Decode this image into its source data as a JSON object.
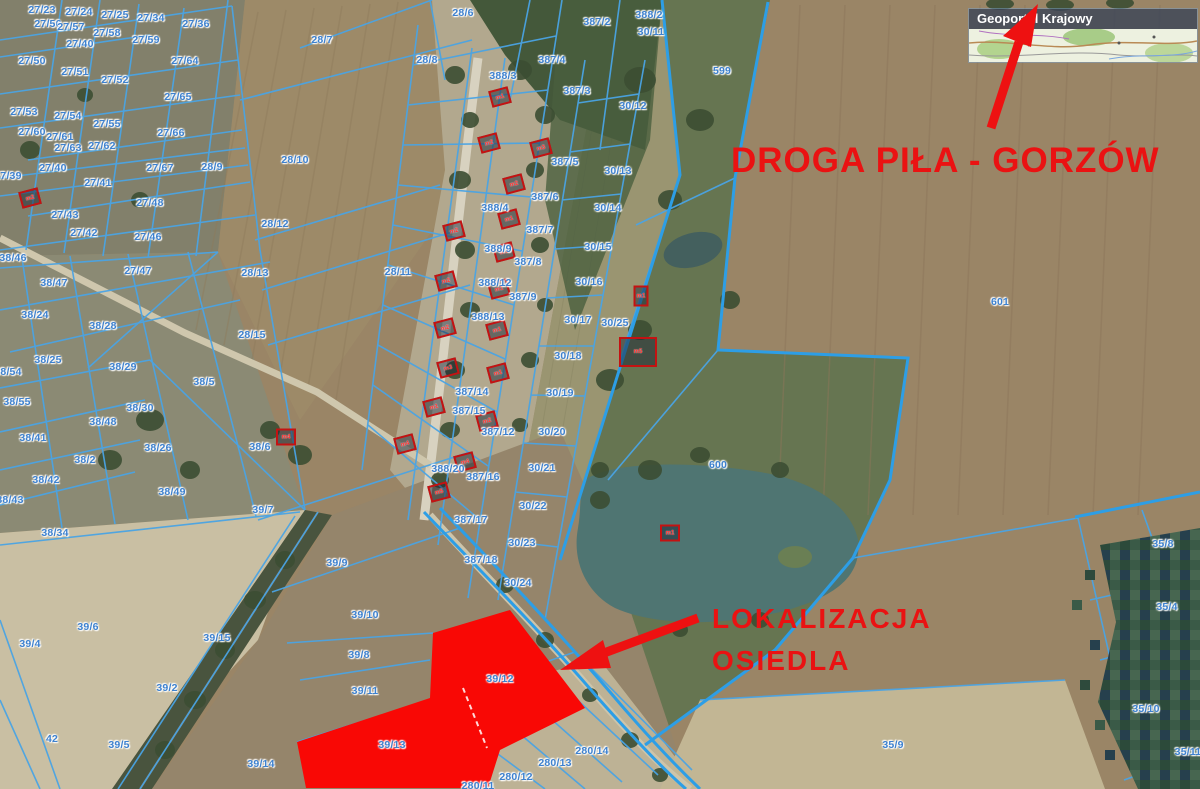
{
  "map": {
    "source_label": "Geoportal Krajowy",
    "annotations": {
      "road_label": "DROGA PIŁA - GORZÓW",
      "location_label_line1": "LOKALIZACJA",
      "location_label_line2": "OSIEDLA"
    },
    "colors": {
      "annotation_red": "#ea1212",
      "highlight_parcel_red": "#f90805",
      "parcel_line_blue": "#4aa3e4",
      "parcel_label_blue": "#3d81cf"
    },
    "highlighted_parcels": [
      "39/12",
      "39/13"
    ],
    "parcel_labels": [
      {
        "text": "27/23",
        "x": 42,
        "y": 10
      },
      {
        "text": "27/24",
        "x": 79,
        "y": 12
      },
      {
        "text": "27/25",
        "x": 115,
        "y": 15
      },
      {
        "text": "27/34",
        "x": 151,
        "y": 18
      },
      {
        "text": "27/36",
        "x": 196,
        "y": 24
      },
      {
        "text": "27/56",
        "x": 48,
        "y": 24
      },
      {
        "text": "27/57",
        "x": 71,
        "y": 27
      },
      {
        "text": "27/58",
        "x": 107,
        "y": 33
      },
      {
        "text": "27/59",
        "x": 146,
        "y": 40
      },
      {
        "text": "27/40",
        "x": 80,
        "y": 44
      },
      {
        "text": "27/50",
        "x": 32,
        "y": 61
      },
      {
        "text": "27/64",
        "x": 185,
        "y": 61
      },
      {
        "text": "27/51",
        "x": 75,
        "y": 72
      },
      {
        "text": "27/52",
        "x": 115,
        "y": 80
      },
      {
        "text": "27/65",
        "x": 178,
        "y": 97
      },
      {
        "text": "27/53",
        "x": 24,
        "y": 112
      },
      {
        "text": "27/54",
        "x": 68,
        "y": 116
      },
      {
        "text": "27/55",
        "x": 107,
        "y": 124
      },
      {
        "text": "27/66",
        "x": 171,
        "y": 133
      },
      {
        "text": "27/60",
        "x": 32,
        "y": 132
      },
      {
        "text": "27/61",
        "x": 60,
        "y": 137
      },
      {
        "text": "27/62",
        "x": 102,
        "y": 146
      },
      {
        "text": "27/63",
        "x": 68,
        "y": 148
      },
      {
        "text": "27/39",
        "x": 8,
        "y": 176
      },
      {
        "text": "27/40",
        "x": 53,
        "y": 168
      },
      {
        "text": "27/41",
        "x": 98,
        "y": 183
      },
      {
        "text": "27/67",
        "x": 160,
        "y": 168
      },
      {
        "text": "28/9",
        "x": 212,
        "y": 167
      },
      {
        "text": "28/10",
        "x": 295,
        "y": 160
      },
      {
        "text": "27/48",
        "x": 150,
        "y": 203
      },
      {
        "text": "27/43",
        "x": 65,
        "y": 215
      },
      {
        "text": "27/42",
        "x": 84,
        "y": 233
      },
      {
        "text": "27/46",
        "x": 148,
        "y": 237
      },
      {
        "text": "28/12",
        "x": 275,
        "y": 224
      },
      {
        "text": "27/47",
        "x": 138,
        "y": 271
      },
      {
        "text": "28/13",
        "x": 255,
        "y": 273
      },
      {
        "text": "28/15",
        "x": 252,
        "y": 335
      },
      {
        "text": "28/7",
        "x": 322,
        "y": 40
      },
      {
        "text": "28/6",
        "x": 463,
        "y": 13
      },
      {
        "text": "28/8",
        "x": 427,
        "y": 60
      },
      {
        "text": "28/11",
        "x": 398,
        "y": 272
      },
      {
        "text": "388/2",
        "x": 649,
        "y": 15
      },
      {
        "text": "387/2",
        "x": 597,
        "y": 22
      },
      {
        "text": "387/4",
        "x": 552,
        "y": 60
      },
      {
        "text": "388/3",
        "x": 503,
        "y": 76
      },
      {
        "text": "387/3",
        "x": 577,
        "y": 91
      },
      {
        "text": "30/11",
        "x": 651,
        "y": 32
      },
      {
        "text": "599",
        "x": 722,
        "y": 71
      },
      {
        "text": "30/12",
        "x": 633,
        "y": 106
      },
      {
        "text": "30/13",
        "x": 618,
        "y": 171
      },
      {
        "text": "30/14",
        "x": 608,
        "y": 208
      },
      {
        "text": "387/5",
        "x": 565,
        "y": 162
      },
      {
        "text": "387/6",
        "x": 545,
        "y": 197
      },
      {
        "text": "388/4",
        "x": 495,
        "y": 208
      },
      {
        "text": "387/7",
        "x": 540,
        "y": 230
      },
      {
        "text": "30/15",
        "x": 598,
        "y": 247
      },
      {
        "text": "388/9",
        "x": 498,
        "y": 249
      },
      {
        "text": "387/8",
        "x": 528,
        "y": 262
      },
      {
        "text": "388/12",
        "x": 495,
        "y": 283
      },
      {
        "text": "387/9",
        "x": 523,
        "y": 297
      },
      {
        "text": "30/16",
        "x": 589,
        "y": 282
      },
      {
        "text": "388/13",
        "x": 488,
        "y": 317
      },
      {
        "text": "30/17",
        "x": 578,
        "y": 320
      },
      {
        "text": "30/25",
        "x": 615,
        "y": 323
      },
      {
        "text": "30/18",
        "x": 568,
        "y": 356
      },
      {
        "text": "387/14",
        "x": 472,
        "y": 392
      },
      {
        "text": "30/19",
        "x": 560,
        "y": 393
      },
      {
        "text": "387/15",
        "x": 469,
        "y": 411
      },
      {
        "text": "387/12",
        "x": 498,
        "y": 432
      },
      {
        "text": "30/20",
        "x": 552,
        "y": 432
      },
      {
        "text": "388/20",
        "x": 448,
        "y": 469
      },
      {
        "text": "387/16",
        "x": 483,
        "y": 477
      },
      {
        "text": "30/21",
        "x": 542,
        "y": 468
      },
      {
        "text": "387/17",
        "x": 471,
        "y": 520
      },
      {
        "text": "30/22",
        "x": 533,
        "y": 506
      },
      {
        "text": "387/18",
        "x": 481,
        "y": 560
      },
      {
        "text": "30/23",
        "x": 522,
        "y": 543
      },
      {
        "text": "30/24",
        "x": 518,
        "y": 583
      },
      {
        "text": "601",
        "x": 1000,
        "y": 302
      },
      {
        "text": "600",
        "x": 718,
        "y": 465
      },
      {
        "text": "38/46",
        "x": 13,
        "y": 258
      },
      {
        "text": "38/47",
        "x": 54,
        "y": 283
      },
      {
        "text": "38/24",
        "x": 35,
        "y": 315
      },
      {
        "text": "38/28",
        "x": 103,
        "y": 326
      },
      {
        "text": "38/25",
        "x": 48,
        "y": 360
      },
      {
        "text": "38/29",
        "x": 123,
        "y": 367
      },
      {
        "text": "38/54",
        "x": 8,
        "y": 372
      },
      {
        "text": "38/55",
        "x": 17,
        "y": 402
      },
      {
        "text": "38/5",
        "x": 204,
        "y": 382
      },
      {
        "text": "38/30",
        "x": 140,
        "y": 408
      },
      {
        "text": "38/48",
        "x": 103,
        "y": 422
      },
      {
        "text": "38/41",
        "x": 33,
        "y": 438
      },
      {
        "text": "38/26",
        "x": 158,
        "y": 448
      },
      {
        "text": "38/6",
        "x": 260,
        "y": 447
      },
      {
        "text": "38/2",
        "x": 85,
        "y": 460
      },
      {
        "text": "38/49",
        "x": 172,
        "y": 492
      },
      {
        "text": "38/42",
        "x": 46,
        "y": 480
      },
      {
        "text": "38/43",
        "x": 10,
        "y": 500
      },
      {
        "text": "39/7",
        "x": 263,
        "y": 510
      },
      {
        "text": "38/34",
        "x": 55,
        "y": 533
      },
      {
        "text": "39/6",
        "x": 88,
        "y": 627
      },
      {
        "text": "39/4",
        "x": 30,
        "y": 644
      },
      {
        "text": "39/15",
        "x": 217,
        "y": 638
      },
      {
        "text": "39/2",
        "x": 167,
        "y": 688
      },
      {
        "text": "42",
        "x": 52,
        "y": 739
      },
      {
        "text": "39/5",
        "x": 119,
        "y": 745
      },
      {
        "text": "39/14",
        "x": 261,
        "y": 764
      },
      {
        "text": "39/9",
        "x": 337,
        "y": 563
      },
      {
        "text": "39/10",
        "x": 365,
        "y": 615
      },
      {
        "text": "39/8",
        "x": 359,
        "y": 655
      },
      {
        "text": "39/11",
        "x": 365,
        "y": 691
      },
      {
        "text": "39/12",
        "x": 500,
        "y": 679
      },
      {
        "text": "39/13",
        "x": 392,
        "y": 745
      },
      {
        "text": "280/14",
        "x": 592,
        "y": 751
      },
      {
        "text": "280/13",
        "x": 555,
        "y": 763
      },
      {
        "text": "280/12",
        "x": 516,
        "y": 777
      },
      {
        "text": "280/11",
        "x": 478,
        "y": 786
      },
      {
        "text": "35/8",
        "x": 1163,
        "y": 544
      },
      {
        "text": "35/4",
        "x": 1167,
        "y": 607
      },
      {
        "text": "35/10",
        "x": 1146,
        "y": 709
      },
      {
        "text": "35/11",
        "x": 1188,
        "y": 752
      },
      {
        "text": "35/9",
        "x": 893,
        "y": 745
      }
    ],
    "building_labels": [
      {
        "text": "m2",
        "x": 30,
        "y": 198,
        "rot": -15
      },
      {
        "text": "m1",
        "x": 500,
        "y": 97,
        "rot": -15
      },
      {
        "text": "m2",
        "x": 489,
        "y": 143,
        "rot": -15
      },
      {
        "text": "m3",
        "x": 541,
        "y": 148,
        "rot": -15
      },
      {
        "text": "m2",
        "x": 514,
        "y": 184,
        "rot": -15
      },
      {
        "text": "m1",
        "x": 509,
        "y": 219,
        "rot": -15
      },
      {
        "text": "m2",
        "x": 454,
        "y": 231,
        "rot": -15
      },
      {
        "text": "m1",
        "x": 504,
        "y": 252,
        "rot": -15
      },
      {
        "text": "m2",
        "x": 446,
        "y": 281,
        "rot": -15
      },
      {
        "text": "m1",
        "x": 499,
        "y": 289,
        "rot": -15
      },
      {
        "text": "m2",
        "x": 445,
        "y": 328,
        "rot": -15
      },
      {
        "text": "m1",
        "x": 497,
        "y": 330,
        "rot": -15
      },
      {
        "text": "m3",
        "x": 448,
        "y": 368,
        "rot": -15
      },
      {
        "text": "m1",
        "x": 498,
        "y": 373,
        "rot": -15
      },
      {
        "text": "m1",
        "x": 434,
        "y": 407,
        "rot": -15
      },
      {
        "text": "m2",
        "x": 487,
        "y": 421,
        "rot": -15
      },
      {
        "text": "m4",
        "x": 405,
        "y": 444,
        "rot": -15
      },
      {
        "text": "m4",
        "x": 465,
        "y": 462,
        "rot": -15
      },
      {
        "text": "m5",
        "x": 439,
        "y": 492,
        "rot": -15
      },
      {
        "text": "m4",
        "x": 286,
        "y": 437,
        "rot": 0
      },
      {
        "text": "m1",
        "x": 641,
        "y": 296,
        "rot": 0,
        "w": 11,
        "h": 17
      },
      {
        "text": "m5",
        "x": 638,
        "y": 352,
        "rot": 0,
        "w": 34,
        "h": 26
      },
      {
        "text": "m1",
        "x": 670,
        "y": 533,
        "rot": 0
      }
    ]
  }
}
